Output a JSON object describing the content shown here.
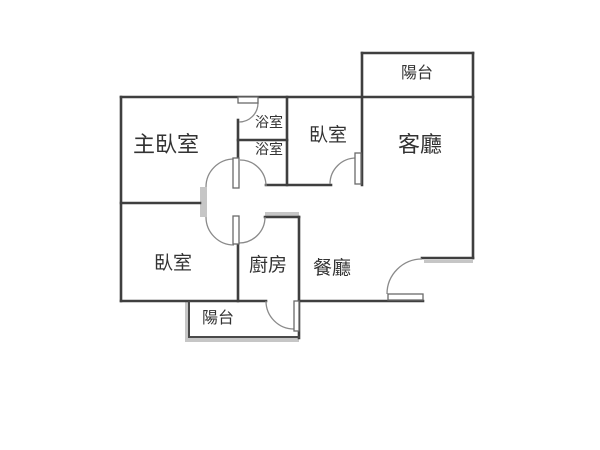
{
  "floor_plan": {
    "title": "apartment-floor-plan",
    "rooms": [
      {
        "id": "master-bedroom",
        "label": "主臥室"
      },
      {
        "id": "bathroom-upper",
        "label": "浴室"
      },
      {
        "id": "bathroom-lower",
        "label": "浴室"
      },
      {
        "id": "bedroom-top",
        "label": "臥室"
      },
      {
        "id": "living-room",
        "label": "客廳"
      },
      {
        "id": "balcony-top",
        "label": "陽台"
      },
      {
        "id": "bedroom-bottom",
        "label": "臥室"
      },
      {
        "id": "kitchen",
        "label": "廚房"
      },
      {
        "id": "dining-room",
        "label": "餐廳"
      },
      {
        "id": "balcony-bottom",
        "label": "陽台"
      }
    ],
    "colors": {
      "wall": "#3f3f3f",
      "door_arc": "#8a8a8a",
      "shadow": "#c6c6c6",
      "text": "#333333",
      "background": "#ffffff"
    }
  }
}
